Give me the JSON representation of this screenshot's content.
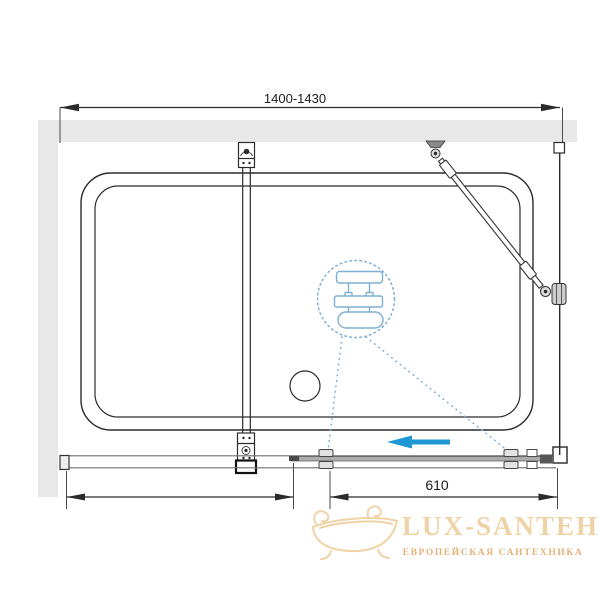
{
  "dimensions": {
    "top_width": "1400-1430",
    "door_width": "610"
  },
  "watermark": {
    "brand": "LUX-SANTEH",
    "tagline": "ЕВРОПЕЙСКАЯ САНТЕХНИКА"
  },
  "colors": {
    "wall_fill": "#E8E8E8",
    "line_dark": "#2B2B2B",
    "rail_gray": "#6F6F6F",
    "door_fill": "#ADADAD",
    "arrow_blue": "#1E97D4",
    "hint_blue": "#7FAFD4",
    "brand_tan": "#EFCE9E",
    "tagline_tan": "#E2A96B"
  },
  "icons": {
    "slide_direction": "arrow-left",
    "hint_symbol": "showerhead",
    "watermark_symbol": "bathtub"
  }
}
